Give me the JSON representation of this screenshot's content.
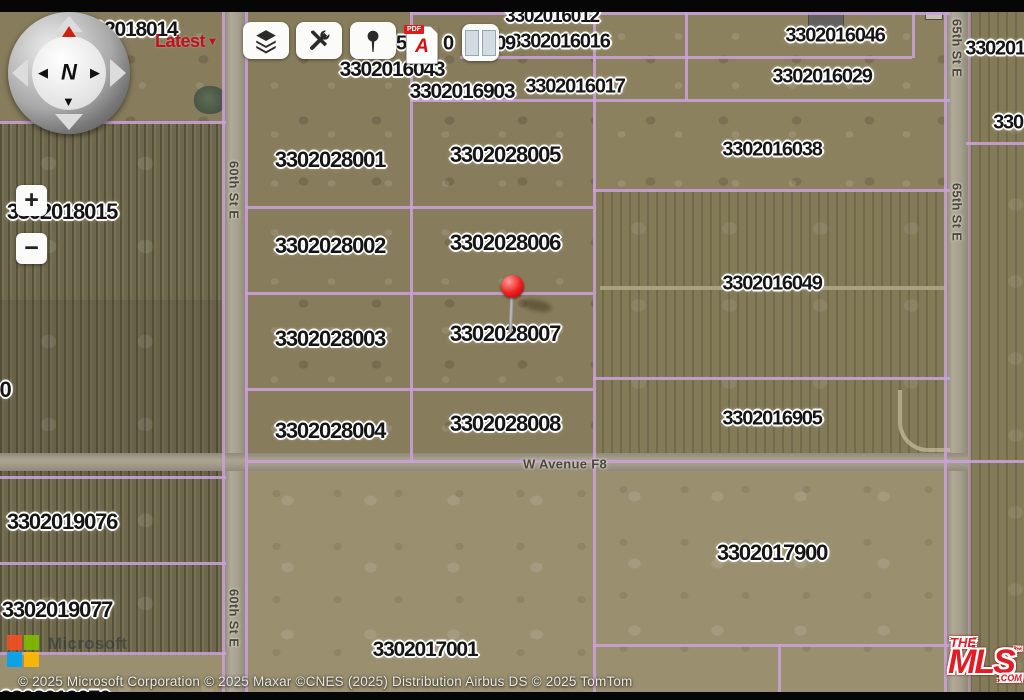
{
  "map": {
    "parcel_labels": [
      {
        "t": "3302018014",
        "x": 125,
        "y": 30,
        "s": 21
      },
      {
        "t": "3302016012",
        "x": 552,
        "y": 17,
        "s": 19
      },
      {
        "t": "3302016016",
        "x": 560,
        "y": 42,
        "s": 20
      },
      {
        "t": "3302016046",
        "x": 835,
        "y": 36,
        "s": 20
      },
      {
        "t": "3302016043",
        "x": 392,
        "y": 70,
        "s": 21
      },
      {
        "t": "3302016017",
        "x": 575,
        "y": 87,
        "s": 20
      },
      {
        "t": "3302016029",
        "x": 822,
        "y": 77,
        "s": 20
      },
      {
        "t": "3302016903",
        "x": 462,
        "y": 92,
        "s": 21
      },
      {
        "t": "3302015",
        "x": 1000,
        "y": 49,
        "s": 20
      },
      {
        "t": "330",
        "x": 1008,
        "y": 123,
        "s": 20
      },
      {
        "t": "3302018015",
        "x": 62,
        "y": 212,
        "s": 22
      },
      {
        "t": "3302016038",
        "x": 772,
        "y": 150,
        "s": 20
      },
      {
        "t": "3302028001",
        "x": 330,
        "y": 160,
        "s": 22
      },
      {
        "t": "3302028005",
        "x": 505,
        "y": 155,
        "s": 22
      },
      {
        "t": "3302028002",
        "x": 330,
        "y": 246,
        "s": 22
      },
      {
        "t": "3302028006",
        "x": 505,
        "y": 243,
        "s": 22
      },
      {
        "t": "3302016049",
        "x": 772,
        "y": 284,
        "s": 20
      },
      {
        "t": "3302028003",
        "x": 330,
        "y": 339,
        "s": 22
      },
      {
        "t": "3302028007",
        "x": 505,
        "y": 334,
        "s": 22
      },
      {
        "t": "0",
        "x": 5,
        "y": 390,
        "s": 22
      },
      {
        "t": "3302028004",
        "x": 330,
        "y": 431,
        "s": 22
      },
      {
        "t": "3302028008",
        "x": 505,
        "y": 424,
        "s": 22
      },
      {
        "t": "3302016905",
        "x": 772,
        "y": 419,
        "s": 20
      },
      {
        "t": "3302019076",
        "x": 62,
        "y": 522,
        "s": 22
      },
      {
        "t": "3302017900",
        "x": 772,
        "y": 553,
        "s": 22
      },
      {
        "t": "3302019077",
        "x": 57,
        "y": 610,
        "s": 22
      },
      {
        "t": "3302017001",
        "x": 425,
        "y": 650,
        "s": 21
      },
      {
        "t": "3302019070",
        "x": 55,
        "y": 699,
        "s": 22
      },
      {
        "t": "5",
        "x": 401,
        "y": 44,
        "s": 20
      },
      {
        "t": "0",
        "x": 448,
        "y": 44,
        "s": 20
      },
      {
        "t": "09",
        "x": 505,
        "y": 44,
        "s": 20
      }
    ],
    "street_labels": [
      {
        "t": "60th St E",
        "x": 234,
        "y": 190,
        "vert": true
      },
      {
        "t": "60th St E",
        "x": 234,
        "y": 618,
        "vert": true
      },
      {
        "t": "65th St E",
        "x": 957,
        "y": 48,
        "vert": true
      },
      {
        "t": "65th St E",
        "x": 957,
        "y": 212,
        "vert": true
      },
      {
        "t": "W Avenue F8",
        "x": 565,
        "y": 464,
        "vert": false
      }
    ],
    "pin": {
      "x": 513,
      "y": 291,
      "color": "#ef2020"
    }
  },
  "controls": {
    "latest_label": "Latest",
    "latest_arrow": "▾",
    "zoom_in": "+",
    "zoom_out": "−",
    "compass_north": "N",
    "pdf_badge": "PDF",
    "pdf_glyph": "A"
  },
  "footer": {
    "attribution": "© 2025 Microsoft Corporation © 2025 Maxar ©CNES (2025) Distribution Airbus DS © 2025 TomTom",
    "microsoft_watermark": "Microsoft"
  },
  "logo": {
    "the": "THE",
    "mls": "MLS",
    "tm": "™",
    "com": ".COM"
  },
  "colors": {
    "parcel_line": "#c9a0d8",
    "pin_red": "#ef2020",
    "mls_red": "#e31b23",
    "latest_red": "#c01022",
    "ms_red": "#f25022",
    "ms_green": "#7fba00",
    "ms_blue": "#00a4ef",
    "ms_yellow": "#ffb900"
  }
}
